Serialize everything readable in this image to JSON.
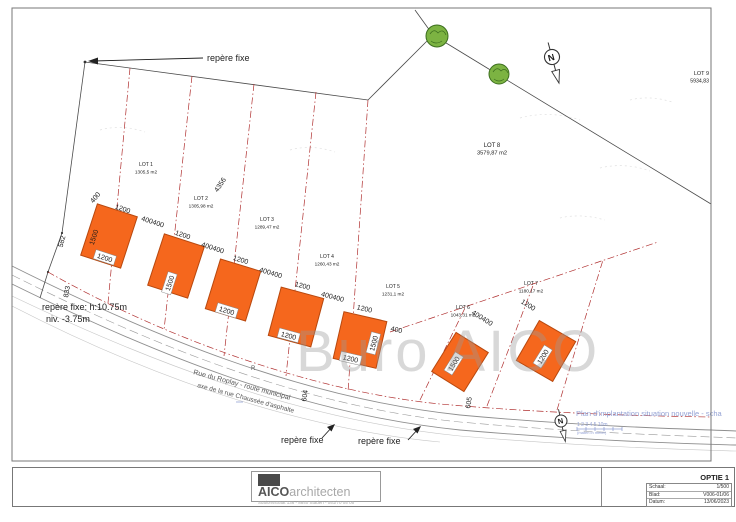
{
  "colors": {
    "building": "#f5671d",
    "building_outline": "#b8480e",
    "lotline": "#b03030",
    "boundary": "#4a4a4a",
    "note_blue": "#93a1d4",
    "watermark": "#9a9a9a",
    "tree_fill": "#7cb342",
    "tree_stroke": "#3c6e1f"
  },
  "watermark": {
    "text": "Buro AICO"
  },
  "logo": {
    "brand_dark": "AICO",
    "brand_light": "architecten",
    "address": "Stationsstraat 136 - 8840 Staden - 051/70 05 05"
  },
  "title_block": {
    "option": "OPTIE 1",
    "rows": [
      {
        "label": "Schaal:",
        "value": "1/500"
      },
      {
        "label": "Blad:",
        "value": "V006-01/06"
      },
      {
        "label": "Datum:",
        "value": "13/06/2023"
      }
    ]
  },
  "drawing": {
    "lots": [
      {
        "name": "LOT 1",
        "area": "1305,5 m2",
        "x": 146,
        "y": 166
      },
      {
        "name": "LOT 2",
        "area": "1305,98 m2",
        "x": 201,
        "y": 200
      },
      {
        "name": "LOT 3",
        "area": "1289,47 m2",
        "x": 267,
        "y": 221
      },
      {
        "name": "LOT 4",
        "area": "1260,43 m2",
        "x": 327,
        "y": 258
      },
      {
        "name": "LOT 5",
        "area": "1231,1 m2",
        "x": 393,
        "y": 288
      },
      {
        "name": "LOT 6",
        "area": "1043,31 m2",
        "x": 463,
        "y": 309
      },
      {
        "name": "LOT 7",
        "area": "1180,17 m2",
        "x": 531,
        "y": 285
      },
      {
        "name": "LOT 8",
        "area": "3579,87 m2",
        "x": 492,
        "y": 147,
        "s": 6
      },
      {
        "name": "LOT 9",
        "area": "5934,83",
        "x": 709,
        "y": 75,
        "s": 5.5,
        "a": "end"
      }
    ],
    "texts": [
      {
        "n": "repere-fixe-top-label",
        "t": "repère fixe",
        "x": 207,
        "y": 61,
        "s": 9,
        "c": "#222"
      },
      {
        "n": "repere-fixe-left-label-1",
        "t": "repère fixe: h:10.75m",
        "x": 42,
        "y": 310,
        "s": 9,
        "c": "#222"
      },
      {
        "n": "repere-fixe-left-label-2",
        "t": "niv. -3.75m",
        "x": 46,
        "y": 322,
        "s": 9,
        "c": "#222"
      },
      {
        "n": "repere-fixe-bottom-label-1",
        "t": "repère fixe",
        "x": 281,
        "y": 443,
        "s": 9,
        "c": "#222"
      },
      {
        "n": "repere-fixe-bottom-label-2",
        "t": "repère fixe",
        "x": 358,
        "y": 444,
        "s": 9,
        "c": "#222"
      },
      {
        "n": "street-name-1",
        "t": "Rue du Roplay - route municipal",
        "x": 193,
        "y": 374,
        "s": 7,
        "c": "#555",
        "r": 15
      },
      {
        "n": "street-name-2",
        "t": "axe de la rue Chaussée d'asphalte",
        "x": 197,
        "y": 387,
        "s": 6.5,
        "c": "#555",
        "r": 15
      },
      {
        "n": "hydrant-symbol",
        "t": "R",
        "x": 251,
        "y": 370,
        "s": 6,
        "c": "#555"
      },
      {
        "n": "plan-note",
        "t": "Plan d'implantation situation nouvelle - scha",
        "x": 576,
        "y": 416,
        "s": 7.5,
        "c": "#93a1d4"
      },
      {
        "n": "scale-bar-numbers",
        "t": "1  2  3  4  5      10m",
        "x": 577,
        "y": 426,
        "s": 5,
        "c": "#93a1d4"
      },
      {
        "n": "scale-bar-caption",
        "t": "(maten in meter)",
        "x": 577,
        "y": 434,
        "s": 4,
        "c": "#93a1d4"
      },
      {
        "n": "north-arrow-top-letter",
        "t": "N",
        "x": 552,
        "y": 60.5,
        "s": 9,
        "a": "middle",
        "b": 1,
        "r": -15
      },
      {
        "n": "north-arrow-bottom-letter",
        "t": "N",
        "x": 561,
        "y": 423.5,
        "s": 7.5,
        "a": "middle",
        "b": 1,
        "r": -12
      }
    ],
    "dims": [
      {
        "t": "400",
        "x": 97,
        "y": 199,
        "r": -50
      },
      {
        "t": "1200",
        "x": 122,
        "y": 211,
        "r": 18
      },
      {
        "t": "400400",
        "x": 152,
        "y": 224,
        "r": 18
      },
      {
        "t": "1500",
        "x": 96,
        "y": 238,
        "r": -72
      },
      {
        "t": "582",
        "x": 64,
        "y": 242,
        "r": -75
      },
      {
        "t": "833",
        "x": 69,
        "y": 292,
        "r": -80
      },
      {
        "t": "1200",
        "x": 104,
        "y": 260,
        "r": 18,
        "box": 1
      },
      {
        "t": "1200",
        "x": 182,
        "y": 237,
        "r": 18
      },
      {
        "t": "400400",
        "x": 212,
        "y": 250,
        "r": 18
      },
      {
        "t": "1500",
        "x": 172,
        "y": 284,
        "r": -72,
        "box": 1
      },
      {
        "t": "1200",
        "x": 240,
        "y": 262,
        "r": 17
      },
      {
        "t": "400400",
        "x": 270,
        "y": 275,
        "r": 17
      },
      {
        "t": "1200",
        "x": 226,
        "y": 313,
        "r": 17,
        "box": 1
      },
      {
        "t": "1200",
        "x": 302,
        "y": 288,
        "r": 15
      },
      {
        "t": "400400",
        "x": 332,
        "y": 299,
        "r": 15
      },
      {
        "t": "1200",
        "x": 288,
        "y": 338,
        "r": 15,
        "box": 1
      },
      {
        "t": "1200",
        "x": 364,
        "y": 311,
        "r": 13
      },
      {
        "t": "400",
        "x": 396,
        "y": 332,
        "r": 13
      },
      {
        "t": "1200",
        "x": 350,
        "y": 361,
        "r": 13,
        "box": 1
      },
      {
        "t": "1500",
        "x": 376,
        "y": 344,
        "r": -75,
        "box": 1
      },
      {
        "t": "4356",
        "x": 222,
        "y": 186,
        "r": -56
      },
      {
        "t": "604",
        "x": 307,
        "y": 396,
        "r": -82
      },
      {
        "t": "605",
        "x": 471,
        "y": 403,
        "r": -82
      },
      {
        "t": "400400",
        "x": 481,
        "y": 320,
        "r": 32
      },
      {
        "t": "1200",
        "x": 527,
        "y": 307,
        "r": 32
      },
      {
        "t": "1500",
        "x": 456,
        "y": 365,
        "r": -58,
        "box": 1
      },
      {
        "t": "1200",
        "x": 545,
        "y": 358,
        "r": -58,
        "box": 1
      }
    ]
  }
}
